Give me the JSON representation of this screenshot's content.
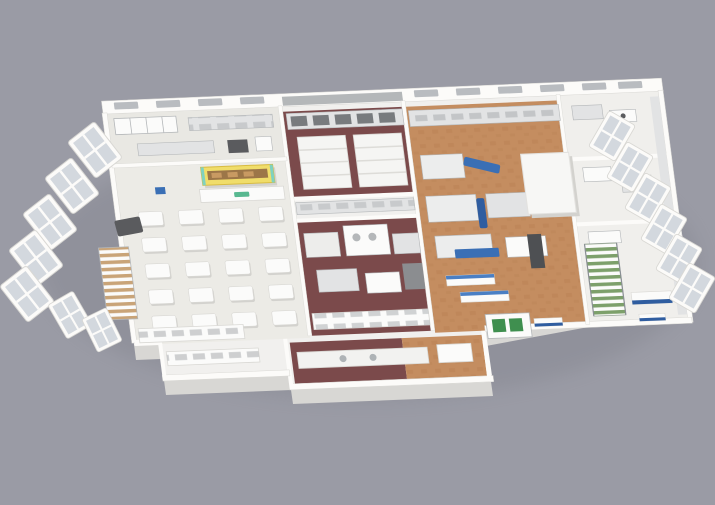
{
  "scene": {
    "kind": "3d-isometric-cutaway-floorplan-render",
    "subject": "Commercial kitchen and food-processing facility, 3D cutaway floor plan on plain gray backdrop",
    "visible_text": "",
    "logo_mark": "small green logo band on dining serving counter (illegible)"
  },
  "colors": {
    "bg": "#9a9ba5",
    "slabTop": "#f1f0ee",
    "slabSide": "#d8d7d4",
    "slabShadow": "#6e6f79",
    "wallWhite": "#fcfbf9",
    "line": "#d9d8d4",
    "shadow": "#d3d2ce",
    "white": "#fbfbfa",
    "floorDining": "#ecebe6",
    "floorPrep": "#e9e8e3",
    "floorWing": "#f0efec",
    "maroon": "#7b4a4b",
    "maroonDark": "#6b3c3e",
    "orange": "#c48d60",
    "orangeDark": "#b37c4f",
    "steel": "#e2e3e4",
    "steelDark": "#b4b7b9",
    "dark": "#5a5b5e",
    "blue": "#3a6fb5",
    "blueDeep": "#2f5da0",
    "yellow": "#f0dd6a",
    "yellowEdge": "#d8bc42",
    "teal": "#7fd2c0",
    "green": "#58b890",
    "machineGreen": "#3f8f4f",
    "wood": "#c9a478",
    "stairGreen": "#7da06b",
    "glass": "#d3d8de",
    "winOpen": "#b9bcc0"
  },
  "inventory": {
    "dining_tables": 20,
    "back_wall_windows": 13,
    "west_window_panels": 7,
    "east_window_panels": 6,
    "staircases": [
      "wood-tread-stair-west",
      "green-tread-stair-east"
    ],
    "floor_zones": [
      {
        "id": "prep-kitchen-north-west",
        "floor": "light"
      },
      {
        "id": "dining-area-west",
        "floor": "light",
        "features": [
          "table-grid",
          "yellow-canopy-serving-counter",
          "green-logo"
        ]
      },
      {
        "id": "cook-room-upper-center",
        "floor": "maroon"
      },
      {
        "id": "cook-room-lower-center",
        "floor": "maroon"
      },
      {
        "id": "processing-hall-east",
        "floor": "terracotta",
        "features": [
          "blue-conveyors",
          "cold-room",
          "green-panel-machine"
        ]
      },
      {
        "id": "lab-wing-far-east",
        "floor": "white"
      },
      {
        "id": "front-service-protrusion",
        "floor": "mixed"
      }
    ]
  }
}
